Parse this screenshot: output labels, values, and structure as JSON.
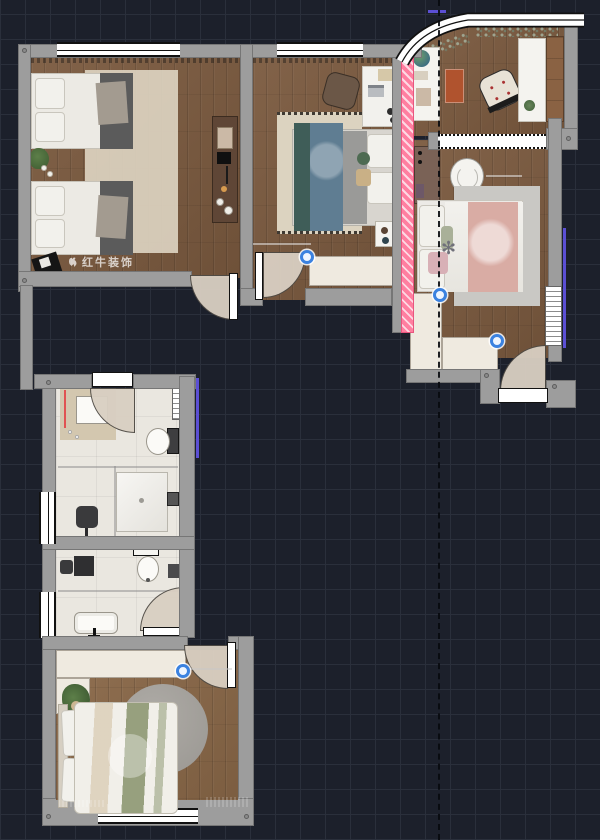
{
  "watermark": {
    "text": "红牛装饰"
  },
  "colors": {
    "bg": "#1c202b",
    "grid": "#2a2f3b",
    "wall": "#9d9d9d",
    "wall_edge": "#767676",
    "wood": "#7b5a3f",
    "wood_light": "#8a6848",
    "tile": "#eae7e0",
    "rug_cream": "#dcd3c0",
    "rug_gray": "#c9c8c4",
    "rug_round": "#9a9792",
    "mat": "#d3c7af",
    "pink": "#ff7fa0",
    "pink_edge": "#e8557f",
    "red": "#e05252",
    "purple": "#5b4fd4",
    "blue": "#3b82e0",
    "teal": "#3f5d58",
    "duvet_blue": "#5f7d92",
    "orange": "#b0532e",
    "dresser": "#5f4636",
    "bed_pink": "#d9aca4",
    "sage": "#97a07e",
    "cream": "#efeae0",
    "arc": "#d9cfc2",
    "door": "#ffffff",
    "line": "#111111",
    "watermark": "rgba(255,255,255,0.72)"
  },
  "markers": [
    {
      "x": 307,
      "y": 257
    },
    {
      "x": 440,
      "y": 295
    },
    {
      "x": 497,
      "y": 341
    },
    {
      "x": 183,
      "y": 671
    }
  ]
}
